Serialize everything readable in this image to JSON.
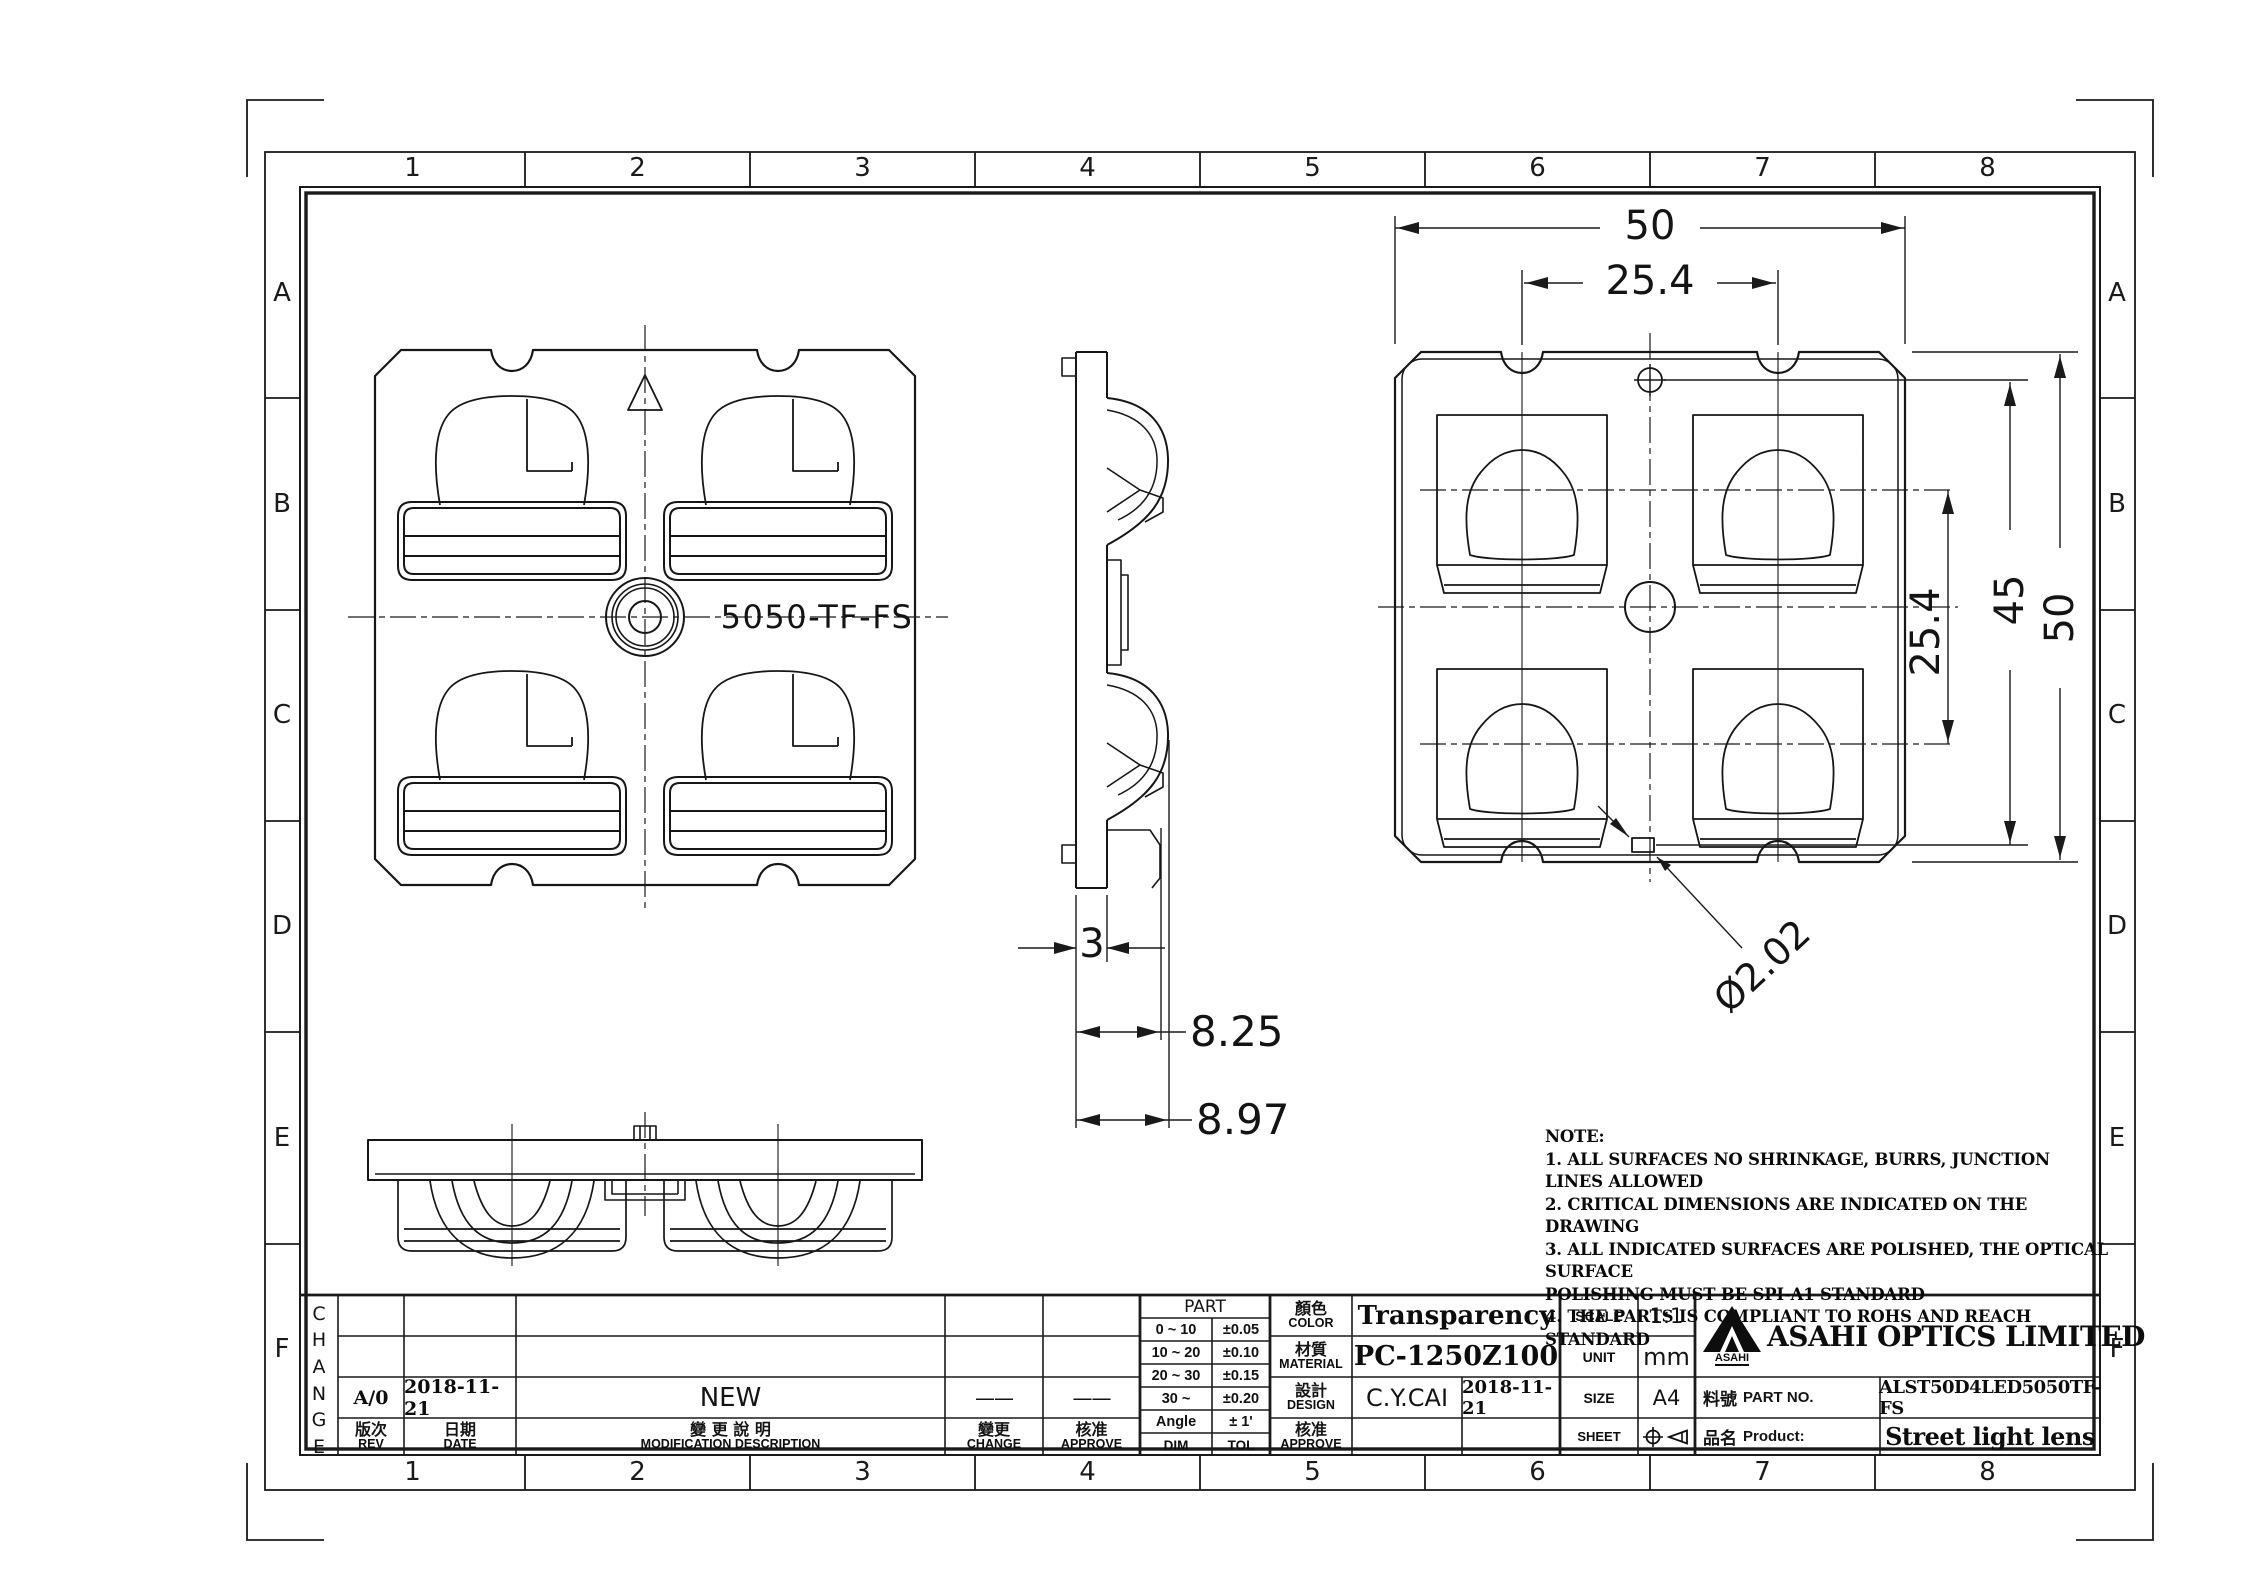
{
  "sheet": {
    "zones": {
      "columns": [
        "1",
        "2",
        "3",
        "4",
        "5",
        "6",
        "7",
        "8"
      ],
      "rows": [
        "A",
        "B",
        "C",
        "D",
        "E",
        "F"
      ]
    },
    "views": {
      "front_label": "5050-TF-FS"
    },
    "dimensions": {
      "overall_width": "50",
      "pitch_horizontal": "25.4",
      "pitch_vertical": "25.4",
      "hole_distance": "45",
      "overall_height": "50",
      "hole_diameter": "Ø2.02",
      "thickness": "3",
      "step_depth": "8.25",
      "overall_depth": "8.97"
    },
    "notes": {
      "title": "NOTE:",
      "lines": [
        "1. ALL SURFACES NO SHRINKAGE, BURRS, JUNCTION LINES ALLOWED",
        "2. CRITICAL DIMENSIONS ARE INDICATED ON THE DRAWING",
        "3. ALL INDICATED SURFACES ARE POLISHED,  THE OPTICAL SURFACE",
        "POLISHING MUST BE SPI-A1 STANDARD",
        "4. THE PARTS IS COMPLIANT TO ROHS AND REACH STANDARD"
      ]
    }
  },
  "revision": {
    "change_vertical": "CHANGE",
    "rows": [
      {
        "rev": "A/0",
        "date": "2018-11-21",
        "description": "NEW",
        "change": "——",
        "approve": "——"
      }
    ],
    "header": {
      "rev_zh": "版次",
      "rev_en": "REV",
      "date_zh": "日期",
      "date_en": "DATE",
      "desc_zh": "變 更 說 明",
      "desc_en": "MODIFICATION  DESCRIPTION",
      "change_zh": "變更",
      "change_en": "CHANGE",
      "approve_zh": "核准",
      "approve_en": "APPROVE"
    }
  },
  "tolerance_table": {
    "title": "PART",
    "rows": [
      [
        "0 ~ 10",
        "±0.05"
      ],
      [
        "10 ~ 20",
        "±0.10"
      ],
      [
        "20 ~ 30",
        "±0.15"
      ],
      [
        "30 ~",
        "±0.20"
      ],
      [
        "Angle",
        "± 1'"
      ]
    ],
    "footer_dim": "DIM",
    "footer_tol": "TOL"
  },
  "title_block": {
    "color": {
      "zh": "顏色",
      "en": "COLOR",
      "value": "Transparency"
    },
    "material": {
      "zh": "材質",
      "en": "MATERIAL",
      "value": "PC-1250Z100"
    },
    "design": {
      "zh": "設計",
      "en": "DESIGN",
      "name": "C.Y.CAI",
      "date": "2018-11-21"
    },
    "approve": {
      "zh": "核准",
      "en": "APPROVE",
      "name": "",
      "date": ""
    },
    "scale": {
      "label": "SCALE",
      "value": "1:1"
    },
    "unit": {
      "label": "UNIT",
      "value": "mm"
    },
    "size": {
      "label": "SIZE",
      "value": "A4"
    },
    "sheet_row": {
      "label": "SHEET"
    },
    "company": {
      "logo_text": "ASAHI",
      "name": "ASAHI OPTICS LIMITED"
    },
    "part_no": {
      "zh": "料號",
      "en": "PART NO.",
      "value": "ALST50D4LED5050TF-FS"
    },
    "product": {
      "zh": "品名",
      "en": "Product:",
      "value": "Street light lens"
    }
  }
}
